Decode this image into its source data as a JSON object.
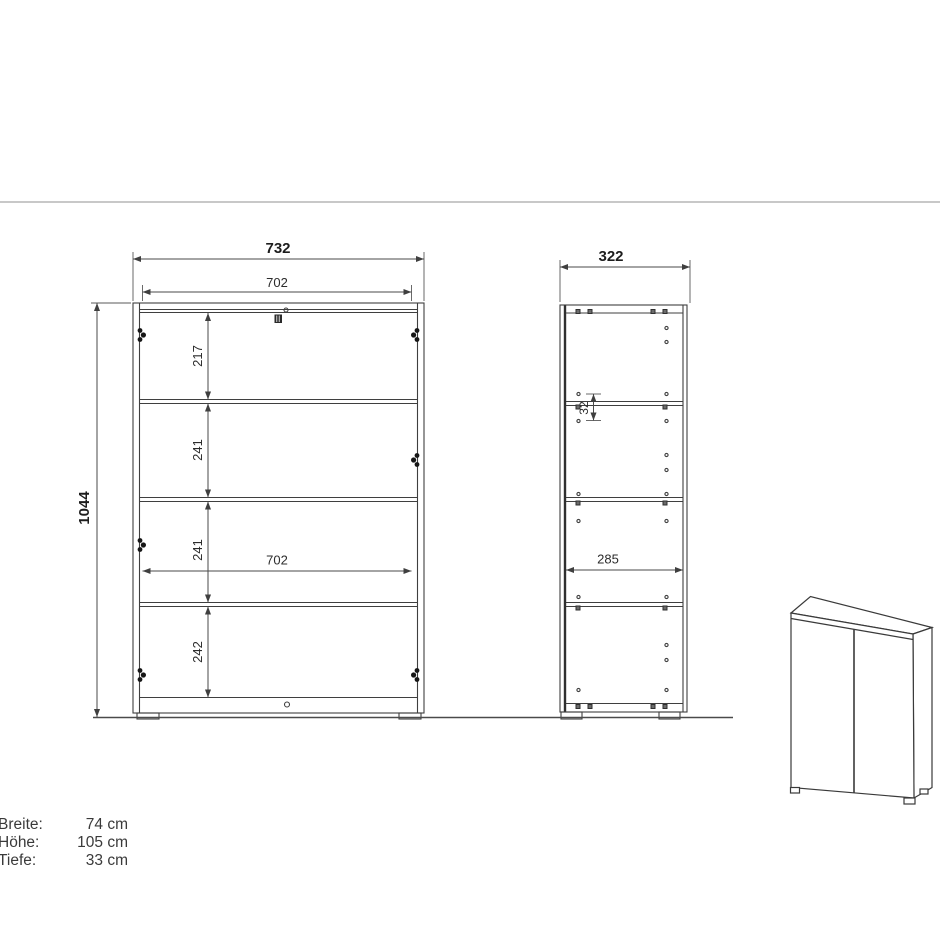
{
  "title": "Cabinet technical drawing",
  "colors": {
    "line": "#3f3f3f",
    "divider": "#c8c8c8",
    "text": "#2c2c2c"
  },
  "front_view": {
    "overall_width_mm": "732",
    "inner_width_top_mm": "702",
    "overall_height_mm": "1044",
    "spacing_top_mm": "217",
    "spacing_second_mm": "241",
    "spacing_third_mm": "241",
    "spacing_bottom_mm": "242",
    "inner_width_mid_mm": "702"
  },
  "side_view": {
    "overall_depth_mm": "322",
    "hole_pitch_mm": "32",
    "inner_depth_mm": "285"
  },
  "specs": {
    "rows": [
      {
        "label": "Breite:",
        "value": "74 cm"
      },
      {
        "label": "Höhe:",
        "value": "105 cm"
      },
      {
        "label": "Tiefe:",
        "value": "33 cm"
      }
    ]
  }
}
